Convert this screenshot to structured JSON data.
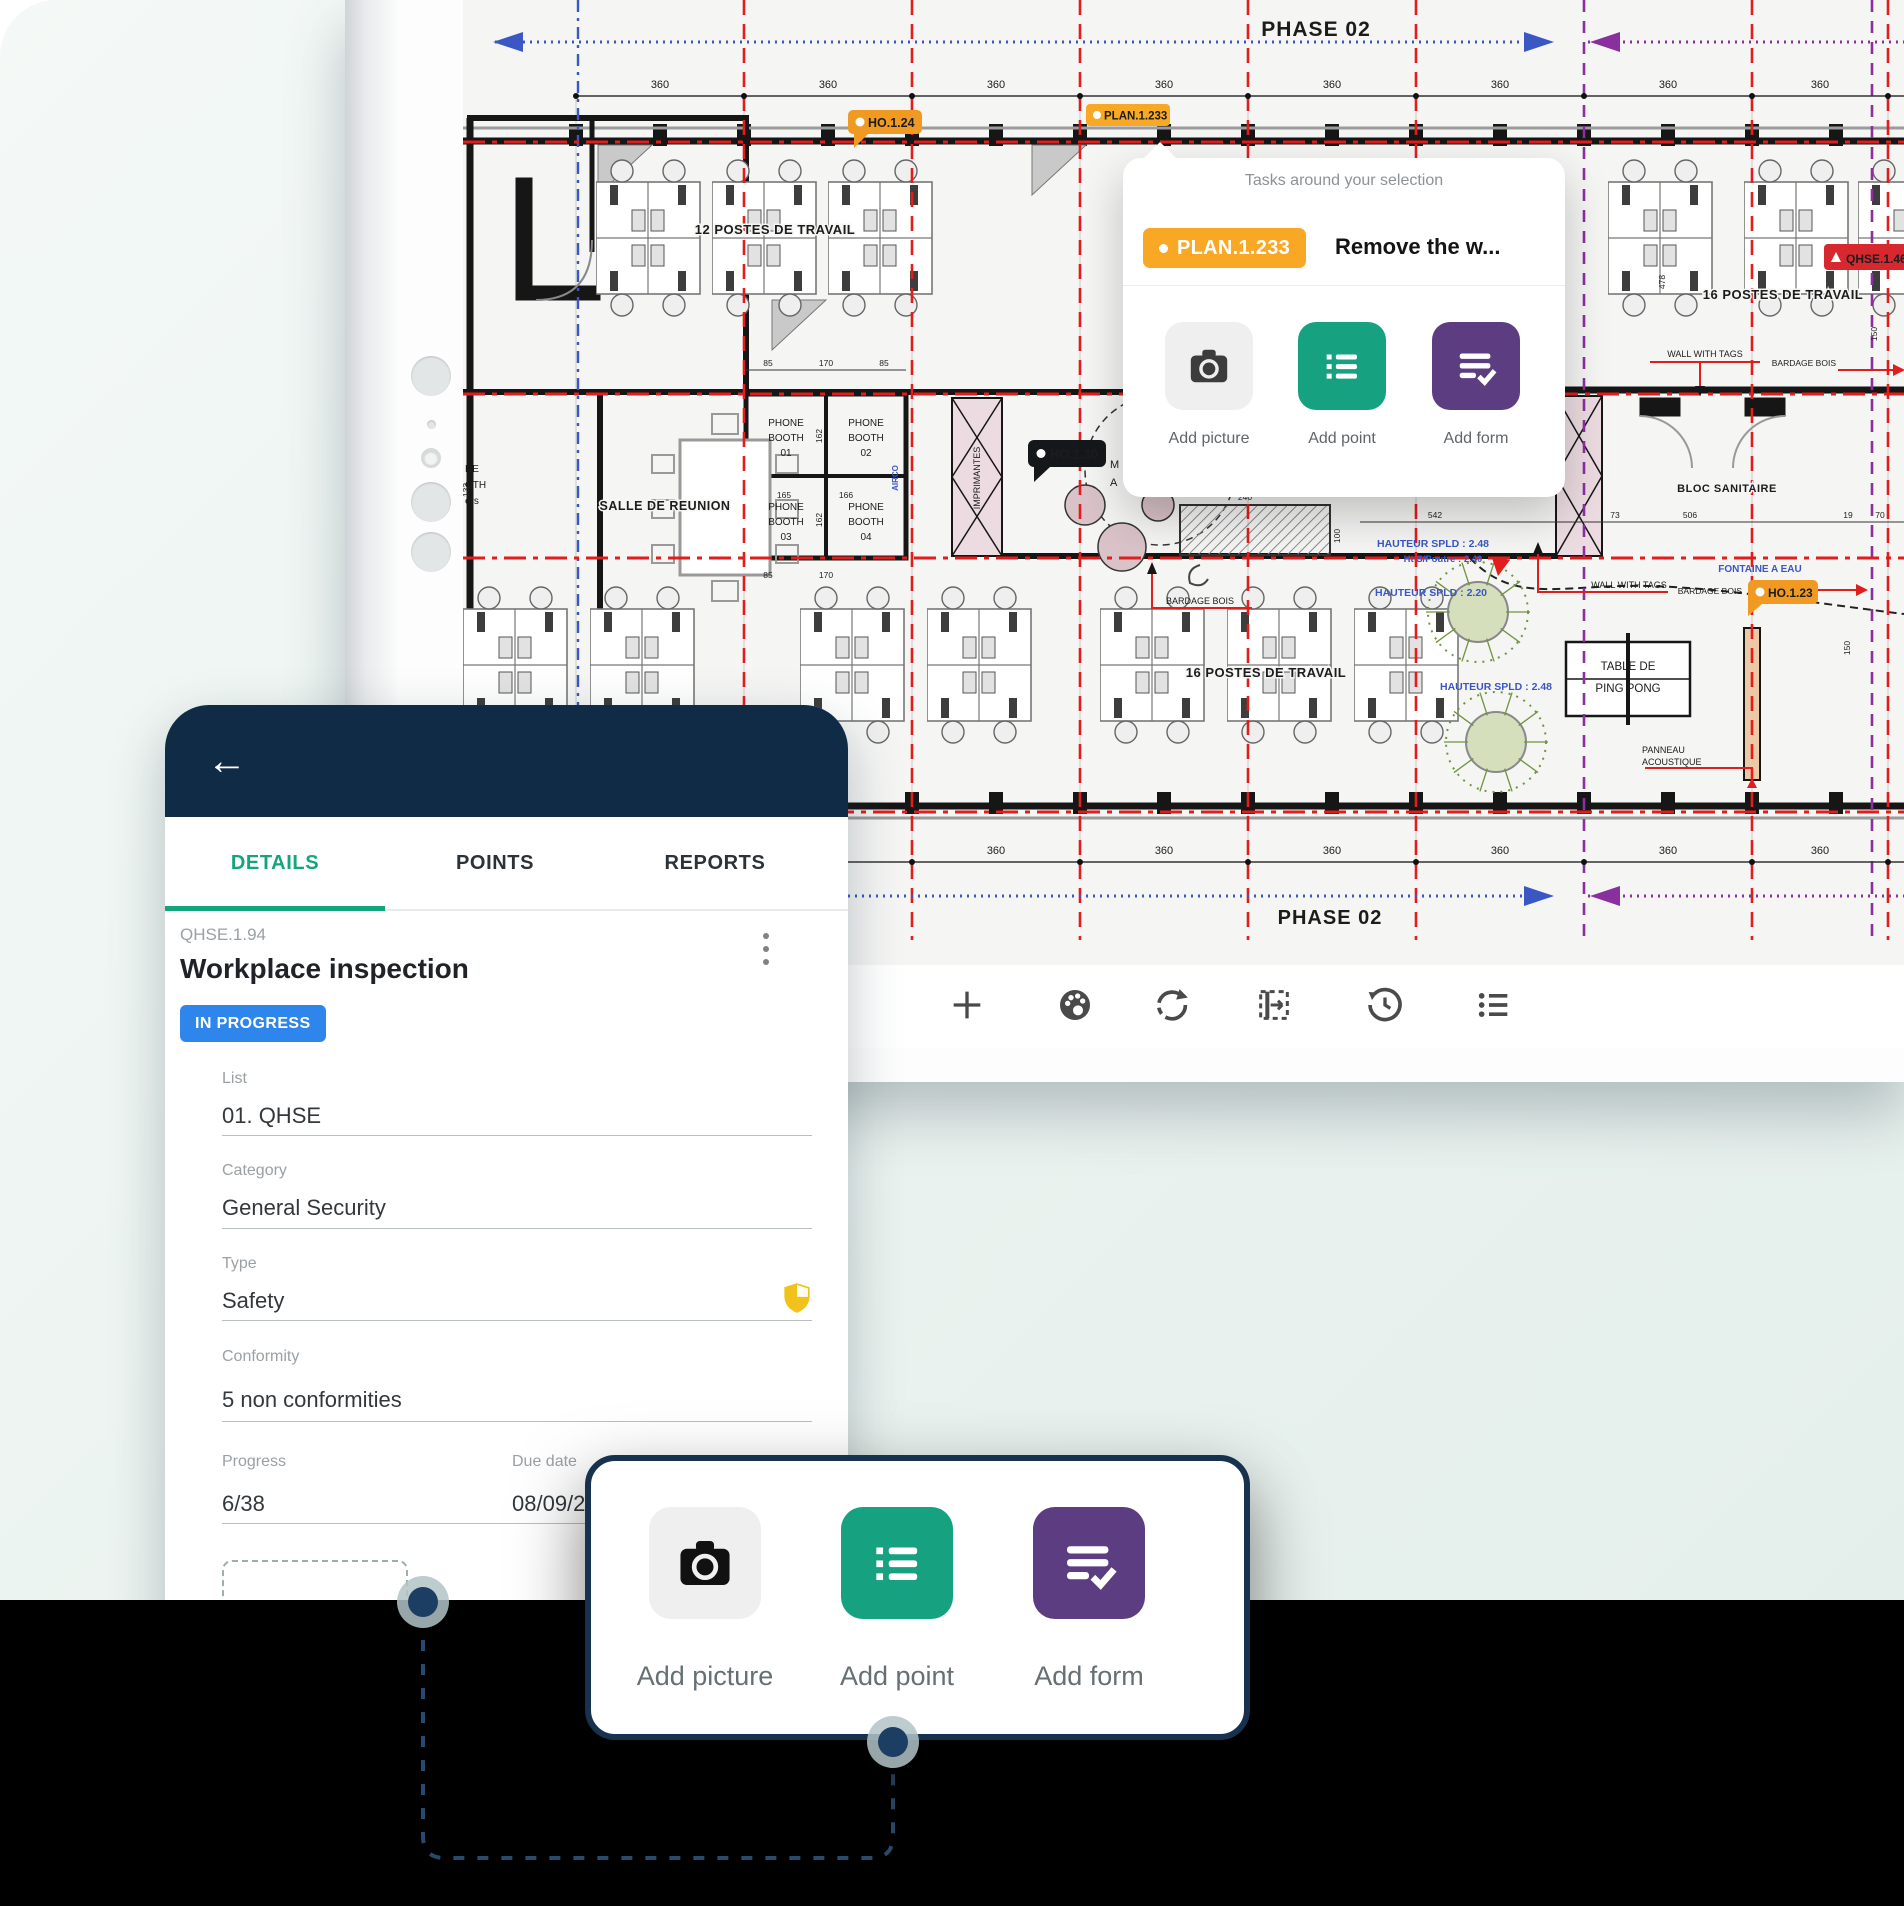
{
  "colors": {
    "navy": "#0f2b46",
    "navy_border": "#16324f",
    "dot_navy": "#1d3e63",
    "green": "#16a280",
    "purple": "#5c3d82",
    "status_blue": "#2e86ec",
    "orange": "#f09a23",
    "orange_bright": "#f9a825",
    "badge_red": "#d7282f",
    "badge_black": "#15181a",
    "phase_blue": "#3a57c4",
    "grid_red": "#e21d1d",
    "grid_purple": "#8a2f9e",
    "shield_yellow": "#f2c21c",
    "tab_green": "#15a57d"
  },
  "plan": {
    "phase_label": "PHASE 02",
    "dim_value": "360",
    "badges": {
      "ho124": "HO.1.24",
      "plan1233": "PLAN.1.233",
      "ho110": "HO.1.10",
      "ho123": "HO.1.23",
      "qhse": "QHSE.1.46"
    },
    "labels": {
      "postes12": "12 POSTES DE TRAVAIL",
      "postes16": "16 POSTES DE TRAVAIL",
      "salle": "SALLE DE REUNION",
      "phone_line": "PHONE",
      "booth_line": "BOOTH",
      "booth_nums": [
        "01",
        "02",
        "03",
        "04"
      ],
      "wall_tags": "WALL WITH TAGS",
      "bardage": "BARDAGE BOIS",
      "fontaine": "FONTAINE A EAU",
      "bloc": "BLOC SANITAIRE",
      "panneau1": "PANNEAU",
      "panneau2": "ACOUSTIQUE",
      "ping1": "TABLE DE",
      "ping2": "PING PONG",
      "haut248": "HAUTEUR SPLD : 2.48",
      "haut220": "HAUTEUR SPLD : 2.20",
      "poutre": "Ht S/Poutre : 2.40",
      "imprimantes": "IMPRIMANTES",
      "airco": "AIRCO",
      "frag1": "NE",
      "frag2": "OTH",
      "frag3": "ers",
      "m": "M",
      "a": "A"
    },
    "dims": {
      "d478": "478",
      "d85": "85",
      "d170": "170",
      "d165": "165",
      "d166": "166",
      "d162": "162",
      "d150": "150",
      "d133": "133",
      "d542": "542",
      "d506": "506",
      "d73": "73",
      "d19": "19",
      "d70": "70",
      "d240": "240",
      "d100": "100"
    }
  },
  "popup": {
    "title": "Tasks around your selection",
    "badge": "PLAN.1.233",
    "task": "Remove the w...",
    "actions": [
      {
        "label": "Add picture"
      },
      {
        "label": "Add point"
      },
      {
        "label": "Add form"
      }
    ]
  },
  "phone": {
    "tabs": [
      {
        "label": "DETAILS"
      },
      {
        "label": "POINTS"
      },
      {
        "label": "REPORTS"
      }
    ],
    "code": "QHSE.1.94",
    "title": "Workplace inspection",
    "status": "IN PROGRESS",
    "fields": [
      {
        "label": "List",
        "value": "01. QHSE"
      },
      {
        "label": "Category",
        "value": "General Security"
      },
      {
        "label": "Type",
        "value": "Safety"
      },
      {
        "label": "Conformity",
        "value": "5 non conformities"
      }
    ],
    "progress": {
      "label": "Progress",
      "value": "6/38"
    },
    "due": {
      "label": "Due date",
      "value": "08/09/2"
    }
  },
  "sheet": {
    "actions": [
      {
        "label": "Add picture"
      },
      {
        "label": "Add point"
      },
      {
        "label": "Add form"
      }
    ]
  }
}
